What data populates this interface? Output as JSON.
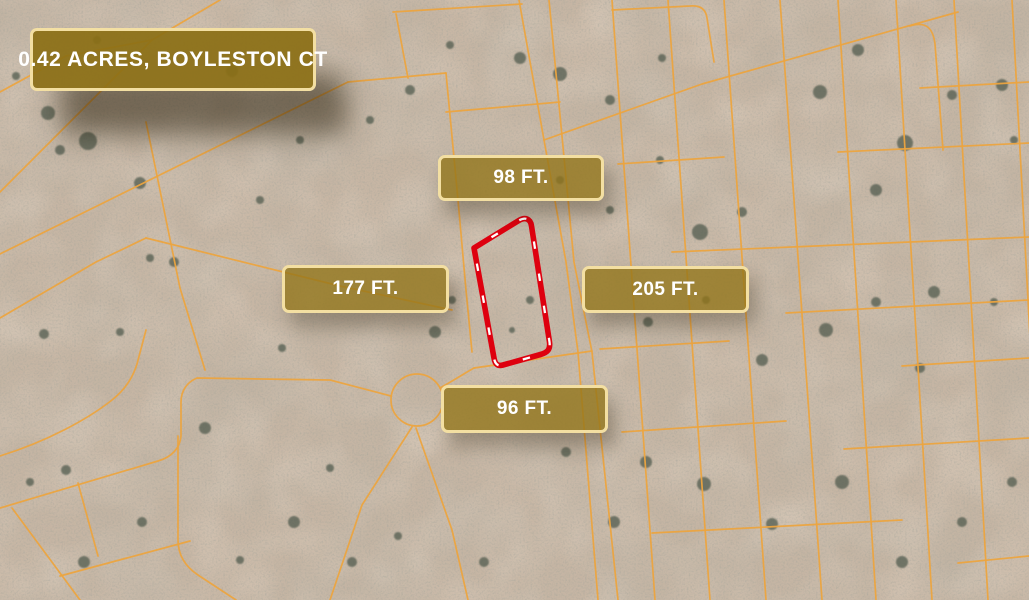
{
  "badges": {
    "title": {
      "text": "0.42 ACRES, BOYLESTON CT"
    },
    "top": {
      "text": "98 FT."
    },
    "left": {
      "text": "177 FT."
    },
    "right": {
      "text": "205 FT."
    },
    "bottom": {
      "text": "96 FT."
    }
  },
  "colors": {
    "terrain": "#c9b8a6",
    "lot_line": "#eca43f",
    "boundary_line": "#de000f",
    "boundary_dash": "#ffffff",
    "badge_fill": "#8b6f15",
    "badge_border": "#f3dfa2",
    "badge_text": "#ffffff"
  }
}
